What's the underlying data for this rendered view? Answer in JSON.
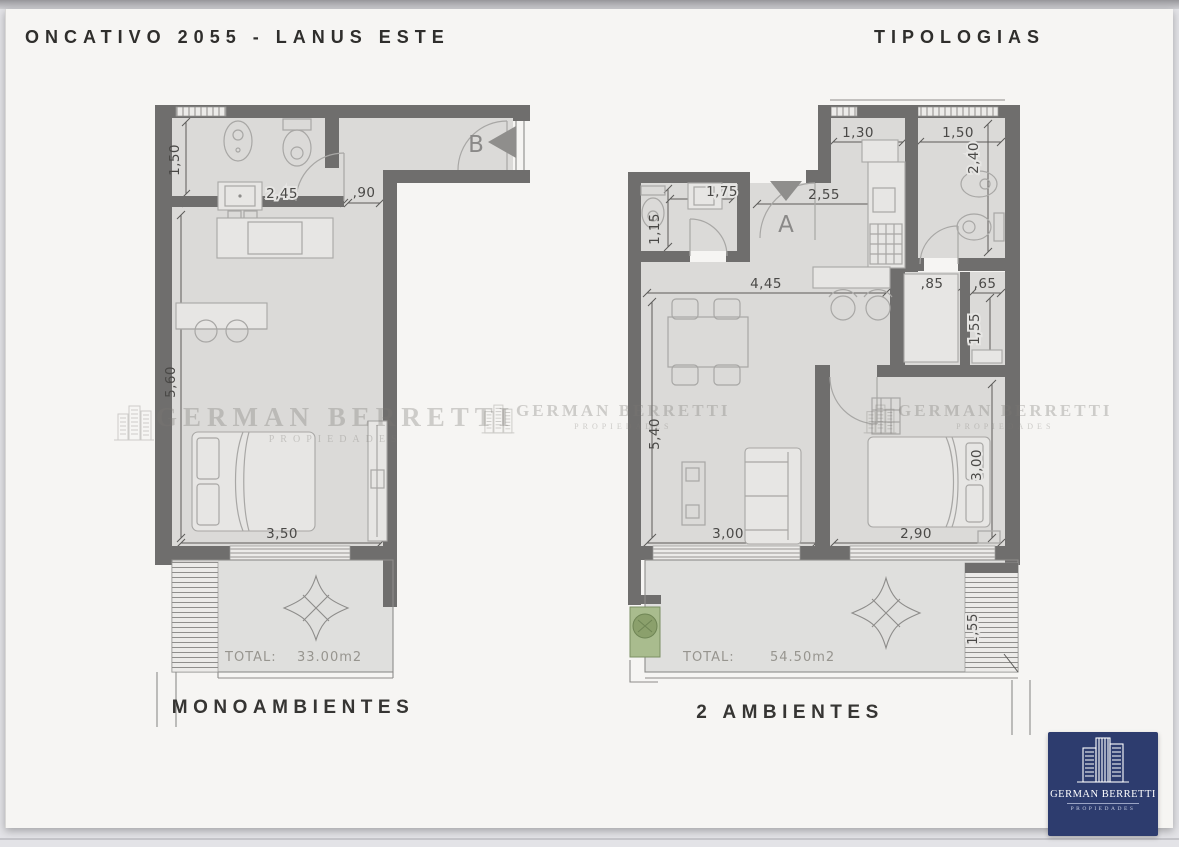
{
  "header": {
    "title": "ONCATIVO 2055 - LANUS ESTE",
    "right_title": "TIPOLOGIAS"
  },
  "mono": {
    "label": "MONOAMBIENTES",
    "entrance": "B",
    "total_label": "TOTAL:",
    "total_value": "33.00m2",
    "dims": {
      "bath_width": "1,50",
      "bath_length": "2,45",
      "hall_width": ",90",
      "room_length": "5,60",
      "room_width": "3,50"
    }
  },
  "dos": {
    "label": "2 AMBIENTES",
    "entrance": "A",
    "total_label": "TOTAL:",
    "total_value": "54.50m2",
    "dims": {
      "kitchen_width": "1,30",
      "bath_width": "1,50",
      "bath_length": "2,40",
      "toilette_length": "1,15",
      "toilette_width": "1,75",
      "entry_width": "2,55",
      "living_width": "4,45",
      "pass_width": ",85",
      "closet_width": ",65",
      "closet_length": "1,55",
      "living_length": "5,40",
      "living_width_bottom": "3,00",
      "bedroom_width": "2,90",
      "bedroom_length": "3,00",
      "stair_length": "1,55"
    }
  },
  "watermark": {
    "name": "GERMAN BERRETTI",
    "subtitle": "PROPIEDADES"
  },
  "logo": {
    "name": "GERMAN BERRETTI",
    "subtitle": "PROPIEDADES"
  },
  "colors": {
    "wall": "#6f6e6d",
    "floor": "#dbdad8",
    "accent_navy": "#2d3c6e",
    "planter_green": "#a9bc8e"
  }
}
